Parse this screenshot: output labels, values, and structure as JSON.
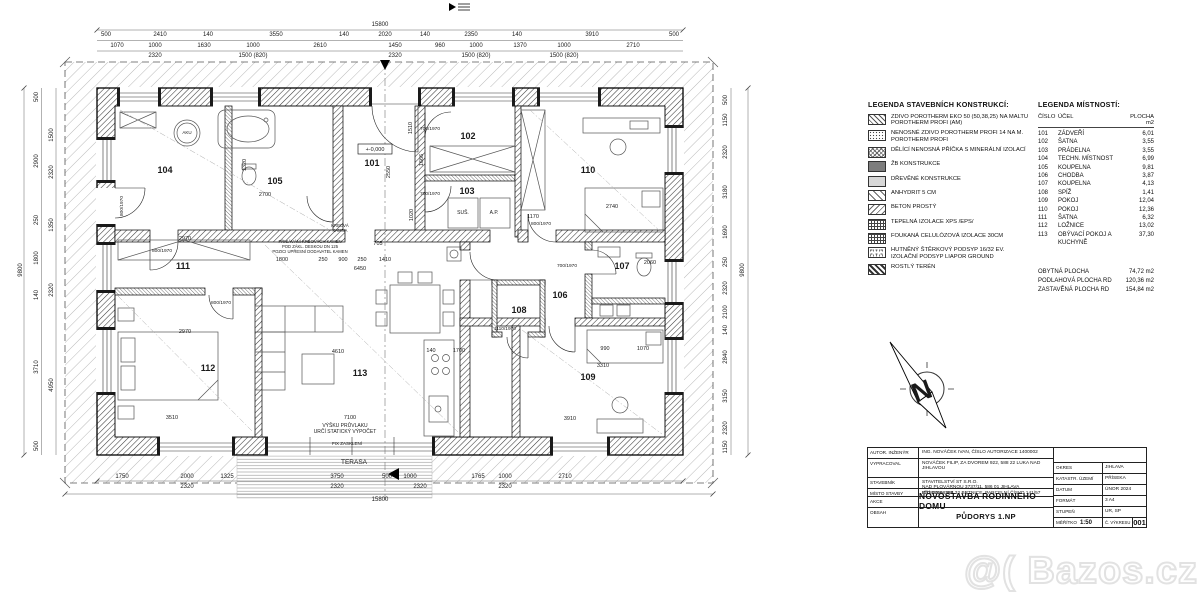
{
  "legend_constructions": {
    "title": "LEGENDA STAVEBNÍCH KONSTRUKCÍ:",
    "items": [
      {
        "pattern": "p-hatch",
        "label": "ZDIVO POROTHERM EKO 50 (50,38,25) NA MALTU POROTHERM PROFI (AM)"
      },
      {
        "pattern": "p-dots",
        "label": "NENOSNÉ ZDIVO POROTHERM PROFI 14 NA M. POROTHERM PROFI"
      },
      {
        "pattern": "p-cross",
        "label": "DĚLÍCÍ NENOSNÁ PŘÍČKA S MINERÁLNÍ IZOLACÍ"
      },
      {
        "pattern": "p-dark",
        "label": "ŽB KONSTRUKCE"
      },
      {
        "pattern": "p-light",
        "label": "DŘEVĚNÉ KONSTRUKCE"
      },
      {
        "pattern": "p-hatch2",
        "label": "ANHYDRIT 5 cm"
      },
      {
        "pattern": "p-back",
        "label": "BETON PROSTÝ"
      },
      {
        "pattern": "p-grid",
        "label": "TEPELNÁ IZOLACE XPS /EPS/"
      },
      {
        "pattern": "p-grid",
        "label": "FOUKANÁ CELULÓZOVÁ IZOLACE 30cm"
      },
      {
        "pattern": "p-speck",
        "label": "HUTNĚNÝ ŠTĚRKOVÝ PODSYP 16/32 EV. IZOLAČNÍ PODSYP LIAPOR GROUND"
      },
      {
        "pattern": "p-terrain",
        "label": "ROSTLÝ TERÉN"
      }
    ]
  },
  "legend_rooms": {
    "title": "LEGENDA MÍSTNOSTÍ:",
    "col_cislo": "ČÍSLO",
    "col_ucel": "ÚČEL",
    "col_plocha": "PLOCHA m2",
    "rows": [
      {
        "cislo": "101",
        "ucel": "ZÁDVEŘÍ",
        "plocha": "6,01"
      },
      {
        "cislo": "102",
        "ucel": "ŠATNA",
        "plocha": "3,55"
      },
      {
        "cislo": "103",
        "ucel": "PRÁDELNA",
        "plocha": "3,55"
      },
      {
        "cislo": "104",
        "ucel": "TECHN. MÍSTNOST",
        "plocha": "6,99"
      },
      {
        "cislo": "105",
        "ucel": "KOUPELNA",
        "plocha": "9,81"
      },
      {
        "cislo": "106",
        "ucel": "CHODBA",
        "plocha": "3,87"
      },
      {
        "cislo": "107",
        "ucel": "KOUPELNA",
        "plocha": "4,13"
      },
      {
        "cislo": "108",
        "ucel": "SPÍŽ",
        "plocha": "1,41"
      },
      {
        "cislo": "109",
        "ucel": "POKOJ",
        "plocha": "12,04"
      },
      {
        "cislo": "110",
        "ucel": "POKOJ",
        "plocha": "12,36"
      },
      {
        "cislo": "111",
        "ucel": "ŠATNA",
        "plocha": "6,32"
      },
      {
        "cislo": "112",
        "ucel": "LOŽNICE",
        "plocha": "13,02"
      },
      {
        "cislo": "113",
        "ucel": "OBÝVACÍ POKOJ A KUCHYNĚ",
        "plocha": "37,30"
      }
    ],
    "totals": [
      {
        "label": "OBYTNÁ PLOCHA",
        "value": "74,72 m2"
      },
      {
        "label": "PODLAHOVÁ PLOCHA RD",
        "value": "120,36 m2"
      },
      {
        "label": "ZASTAVĚNÁ PLOCHA RD",
        "value": "154,84 m2"
      }
    ]
  },
  "title_block": {
    "rows": [
      {
        "label": "AUTOR. INŽENÝR",
        "value": "ING. NOVÁČEK IVAN, ČÍSLO AUTORIZACE 1400002"
      },
      {
        "label": "VYPRACOVAL",
        "value": "NOVÁČEK FILIP, ZA DVOREM 922, 588 22 LUKA NAD JIHLAVOU"
      },
      {
        "label": "STAVEBNÍK",
        "value": "STAVITELSTVÍ ST S.R.O.\nNAD PLOVÁRNOU 3737/11, 586 01 JIHLAVA\nIČO 07998384"
      },
      {
        "label": "MÍSTO STAVBY",
        "value": "PŘÍSEKA, 588 32 BRTNICE, PARCELNÍ ČÍSLO 141/57"
      }
    ],
    "akce_label": "AKCE",
    "akce": "NOVOSTAVBA RODINNÉHO DOMU",
    "obsah_label": "OBSAH",
    "obsah": "PŮDORYS 1.NP",
    "info": [
      {
        "label": "OKRES",
        "value": "JIHLAVA"
      },
      {
        "label": "KATASTR. ÚZEMÍ",
        "value": "PŘÍSEKA"
      },
      {
        "label": "DATUM",
        "value": "ÚNOR 2024"
      },
      {
        "label": "FORMÁT",
        "value": "3 A4"
      },
      {
        "label": "STUPEŇ",
        "value": "UR, SP"
      }
    ],
    "meritko_label": "MĚŘÍTKO",
    "meritko": "1:50",
    "cvyk_label": "Č. VÝKRESU",
    "cvyk": "001"
  },
  "north_arrow": {
    "letter": "N"
  },
  "watermark": {
    "prefix": "@(",
    "text": "Bazos.cz"
  },
  "plan": {
    "labels": [
      [
        380,
        26,
        "15800"
      ],
      [
        106,
        36,
        "500"
      ],
      [
        160,
        36,
        "2410"
      ],
      [
        208,
        36,
        "140"
      ],
      [
        276,
        36,
        "3550"
      ],
      [
        344,
        36,
        "140"
      ],
      [
        385,
        36,
        "2020"
      ],
      [
        425,
        36,
        "140"
      ],
      [
        471,
        36,
        "2350"
      ],
      [
        517,
        36,
        "140"
      ],
      [
        592,
        36,
        "3910"
      ],
      [
        674,
        36,
        "500"
      ],
      [
        117,
        47,
        "1070"
      ],
      [
        155,
        47,
        "1000"
      ],
      [
        204,
        47,
        "1630"
      ],
      [
        253,
        47,
        "1000"
      ],
      [
        320,
        47,
        "2610"
      ],
      [
        395,
        47,
        "1450"
      ],
      [
        440,
        47,
        "960"
      ],
      [
        476,
        47,
        "1000"
      ],
      [
        520,
        47,
        "1370"
      ],
      [
        564,
        47,
        "1000"
      ],
      [
        633,
        47,
        "2710"
      ],
      [
        155,
        57,
        "2320"
      ],
      [
        253,
        57,
        "1500 (820)"
      ],
      [
        395,
        57,
        "2320"
      ],
      [
        476,
        57,
        "1500 (820)"
      ],
      [
        564,
        57,
        "1500 (820)"
      ],
      [
        122,
        478,
        "1750"
      ],
      [
        187,
        478,
        "2000"
      ],
      [
        227,
        478,
        "1325"
      ],
      [
        337,
        478,
        "3750"
      ],
      [
        387,
        478,
        "500"
      ],
      [
        410,
        478,
        "1000"
      ],
      [
        478,
        478,
        "1765"
      ],
      [
        505,
        478,
        "1000"
      ],
      [
        565,
        478,
        "2710"
      ],
      [
        187,
        488,
        "2320"
      ],
      [
        337,
        488,
        "2320"
      ],
      [
        420,
        488,
        "2320"
      ],
      [
        505,
        488,
        "2320"
      ],
      [
        380,
        501,
        "15800"
      ],
      [
        354,
        464,
        "TERASA",
        0,
        6.5
      ],
      [
        38,
        97,
        "500",
        -90
      ],
      [
        38,
        161,
        "2900",
        -90
      ],
      [
        38,
        220,
        "250",
        -90
      ],
      [
        38,
        258,
        "1800",
        -90
      ],
      [
        38,
        295,
        "140",
        -90
      ],
      [
        38,
        367,
        "3710",
        -90
      ],
      [
        38,
        446,
        "500",
        -90
      ],
      [
        53,
        135,
        "1500",
        -90
      ],
      [
        53,
        172,
        "2320",
        -90
      ],
      [
        53,
        225,
        "1350",
        -90
      ],
      [
        53,
        290,
        "2320",
        -90
      ],
      [
        53,
        385,
        "4950",
        -90
      ],
      [
        22,
        270,
        "9800",
        -90
      ],
      [
        727,
        100,
        "500",
        -90
      ],
      [
        727,
        120,
        "1150",
        -90
      ],
      [
        727,
        152,
        "2320",
        -90
      ],
      [
        727,
        192,
        "3180",
        -90
      ],
      [
        727,
        232,
        "1690",
        -90
      ],
      [
        727,
        262,
        "250",
        -90
      ],
      [
        727,
        288,
        "2320",
        -90
      ],
      [
        727,
        312,
        "2100",
        -90
      ],
      [
        727,
        330,
        "140",
        -90
      ],
      [
        727,
        357,
        "2840",
        -90
      ],
      [
        727,
        396,
        "3150",
        -90
      ],
      [
        727,
        428,
        "2320",
        -90
      ],
      [
        727,
        447,
        "1150",
        -90
      ],
      [
        744,
        270,
        "9800",
        -90
      ],
      [
        372,
        166,
        "101",
        0,
        9,
        1
      ],
      [
        468,
        139,
        "102",
        0,
        9,
        1
      ],
      [
        467,
        194,
        "103",
        0,
        9,
        1
      ],
      [
        165,
        173,
        "104",
        0,
        9,
        1
      ],
      [
        275,
        184,
        "105",
        0,
        9,
        1
      ],
      [
        560,
        298,
        "106",
        0,
        9,
        1
      ],
      [
        622,
        269,
        "107",
        0,
        9,
        1
      ],
      [
        519,
        313,
        "108",
        0,
        9,
        1
      ],
      [
        588,
        380,
        "109",
        0,
        9,
        1
      ],
      [
        588,
        173,
        "110",
        0,
        9,
        1
      ],
      [
        183,
        269,
        "111",
        0,
        9,
        1
      ],
      [
        208,
        371,
        "112",
        0,
        9,
        1
      ],
      [
        360,
        376,
        "113",
        0,
        9,
        1
      ],
      [
        185,
        240,
        "2970",
        0,
        5.5
      ],
      [
        185,
        333,
        "2970",
        0,
        5.5
      ],
      [
        172,
        419,
        "3510",
        0,
        5.5
      ],
      [
        338,
        353,
        "4610",
        0,
        5.5
      ],
      [
        350,
        419,
        "7100",
        0,
        5.5
      ],
      [
        431,
        352,
        "140",
        0,
        5.5
      ],
      [
        459,
        352,
        "1700",
        0,
        5.5
      ],
      [
        603,
        367,
        "3310",
        0,
        5.5
      ],
      [
        605,
        350,
        "990",
        0,
        5.5
      ],
      [
        643,
        350,
        "1070",
        0,
        5.5
      ],
      [
        570,
        420,
        "3910",
        0,
        5.5
      ],
      [
        612,
        208,
        "2740",
        0,
        5.5
      ],
      [
        533,
        218,
        "1170",
        0,
        5.5
      ],
      [
        650,
        264,
        "2060",
        0,
        5.5
      ],
      [
        282,
        261,
        "1800",
        0,
        5.5
      ],
      [
        323,
        261,
        "250",
        0,
        5.5
      ],
      [
        343,
        261,
        "900",
        0,
        5.5
      ],
      [
        362,
        261,
        "250",
        0,
        5.5
      ],
      [
        385,
        261,
        "1410",
        0,
        5.5
      ],
      [
        360,
        270,
        "6450",
        0,
        5.5
      ],
      [
        265,
        196,
        "2700",
        0,
        5.5
      ],
      [
        378,
        245,
        "705",
        0,
        5.5
      ],
      [
        246,
        165,
        "1320",
        -90,
        5.5
      ],
      [
        390,
        172,
        "2550",
        -90,
        5.5
      ],
      [
        412,
        128,
        "1510",
        -90,
        5.5
      ],
      [
        423,
        160,
        "1666",
        -90,
        5.5
      ],
      [
        413,
        215,
        "1020",
        -90,
        5.5
      ],
      [
        430,
        130,
        "700/1970",
        0,
        4.8
      ],
      [
        430,
        195,
        "700/1970",
        0,
        4.8
      ],
      [
        567,
        267,
        "700/1970",
        0,
        4.8
      ],
      [
        505,
        330,
        "1110/1970",
        0,
        4.8
      ],
      [
        123,
        206,
        "800/1970",
        -90,
        4.8
      ],
      [
        221,
        304,
        "800/1970",
        0,
        4.8
      ],
      [
        541,
        225,
        "800/1970",
        0,
        4.8
      ],
      [
        162,
        252,
        "800/1970",
        0,
        4.8
      ],
      [
        375,
        151,
        "+-0,000",
        0,
        5.5
      ],
      [
        463,
        214,
        "SUŠ.",
        0,
        5
      ],
      [
        494,
        214,
        "A.P.",
        0,
        5
      ],
      [
        187,
        134,
        "AKU",
        0,
        4.5
      ],
      [
        340,
        227,
        "KRBOVÁ",
        0,
        4.2
      ],
      [
        340,
        232,
        "KAMNA",
        0,
        4.2
      ],
      [
        310,
        243,
        "PŘISÁVÁNÍ KRBOVÝCH KAMEN",
        0,
        4.2
      ],
      [
        310,
        248,
        "POD ZÁKL. DESKOU DN 125",
        0,
        4.2
      ],
      [
        310,
        253,
        "POZICI UPŘESNÍ DODAVATEL KAMEN",
        0,
        4.2
      ],
      [
        345,
        427,
        "VÝŠKU PRŮVLAKU",
        0,
        5
      ],
      [
        345,
        433,
        "URČÍ STATICKÝ VÝPOČET",
        0,
        5
      ],
      [
        347,
        445,
        "FIX ZASKLENÍ",
        0,
        4.5
      ]
    ]
  }
}
